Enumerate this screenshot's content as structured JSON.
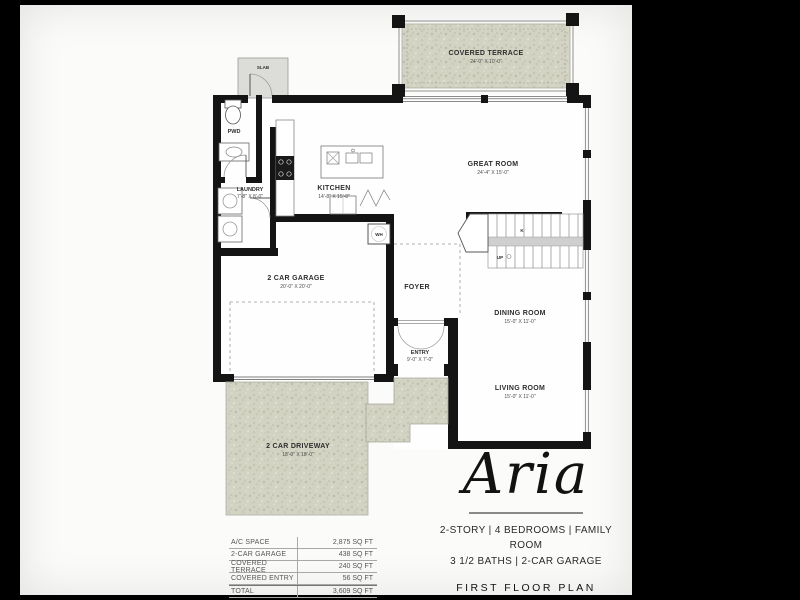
{
  "plan": {
    "rooms": {
      "covered_terrace": {
        "label": "COVERED TERRACE",
        "dims": "24'-0\" X 10'-0\""
      },
      "great_room": {
        "label": "GREAT ROOM",
        "dims": "24'-4\" X 15'-0\""
      },
      "kitchen": {
        "label": "KITCHEN",
        "dims": "14'-8\" X 15'-8\""
      },
      "laundry": {
        "label": "LAUNDRY",
        "dims": "7'-8\" X 8'-0\""
      },
      "pwd": {
        "label": "PWD"
      },
      "slab": {
        "label": "SLAB"
      },
      "wh": {
        "label": "WH"
      },
      "garage": {
        "label": "2 CAR GARAGE",
        "dims": "20'-0\" X 20'-0\""
      },
      "foyer": {
        "label": "FOYER"
      },
      "entry": {
        "label": "ENTRY",
        "dims": "9'-0\" X 7'-0\""
      },
      "dining": {
        "label": "DINING ROOM",
        "dims": "15'-0\" X 11'-0\""
      },
      "living": {
        "label": "LIVING ROOM",
        "dims": "15'-0\" X 11'-0\""
      },
      "driveway": {
        "label": "2 CAR DRIVEWAY",
        "dims": "18'-0\" X 18'-0\""
      },
      "stairs": {
        "up_label": "UP",
        "marker": "K"
      }
    }
  },
  "area_table": {
    "rows": [
      {
        "label": "A/C SPACE",
        "value": "2,875 SQ FT"
      },
      {
        "label": "2-CAR GARAGE",
        "value": "438 SQ FT"
      },
      {
        "label": "COVERED TERRACE",
        "value": "240 SQ FT"
      },
      {
        "label": "COVERED ENTRY",
        "value": "56 SQ FT"
      },
      {
        "label": "TOTAL",
        "value": "3,609 SQ FT"
      }
    ]
  },
  "brand": {
    "logo": "Aria",
    "features_line1": "2-STORY | 4 BEDROOMS | FAMILY ROOM",
    "features_line2": "3 1/2 BATHS | 2-CAR GARAGE",
    "plan_title": "FIRST FLOOR PLAN"
  },
  "colors": {
    "background": "#000000",
    "sheet": "#fbfbf9",
    "walls": "#141414",
    "texture": "#d3d3c3",
    "table_lines": "#a8a8a8"
  }
}
